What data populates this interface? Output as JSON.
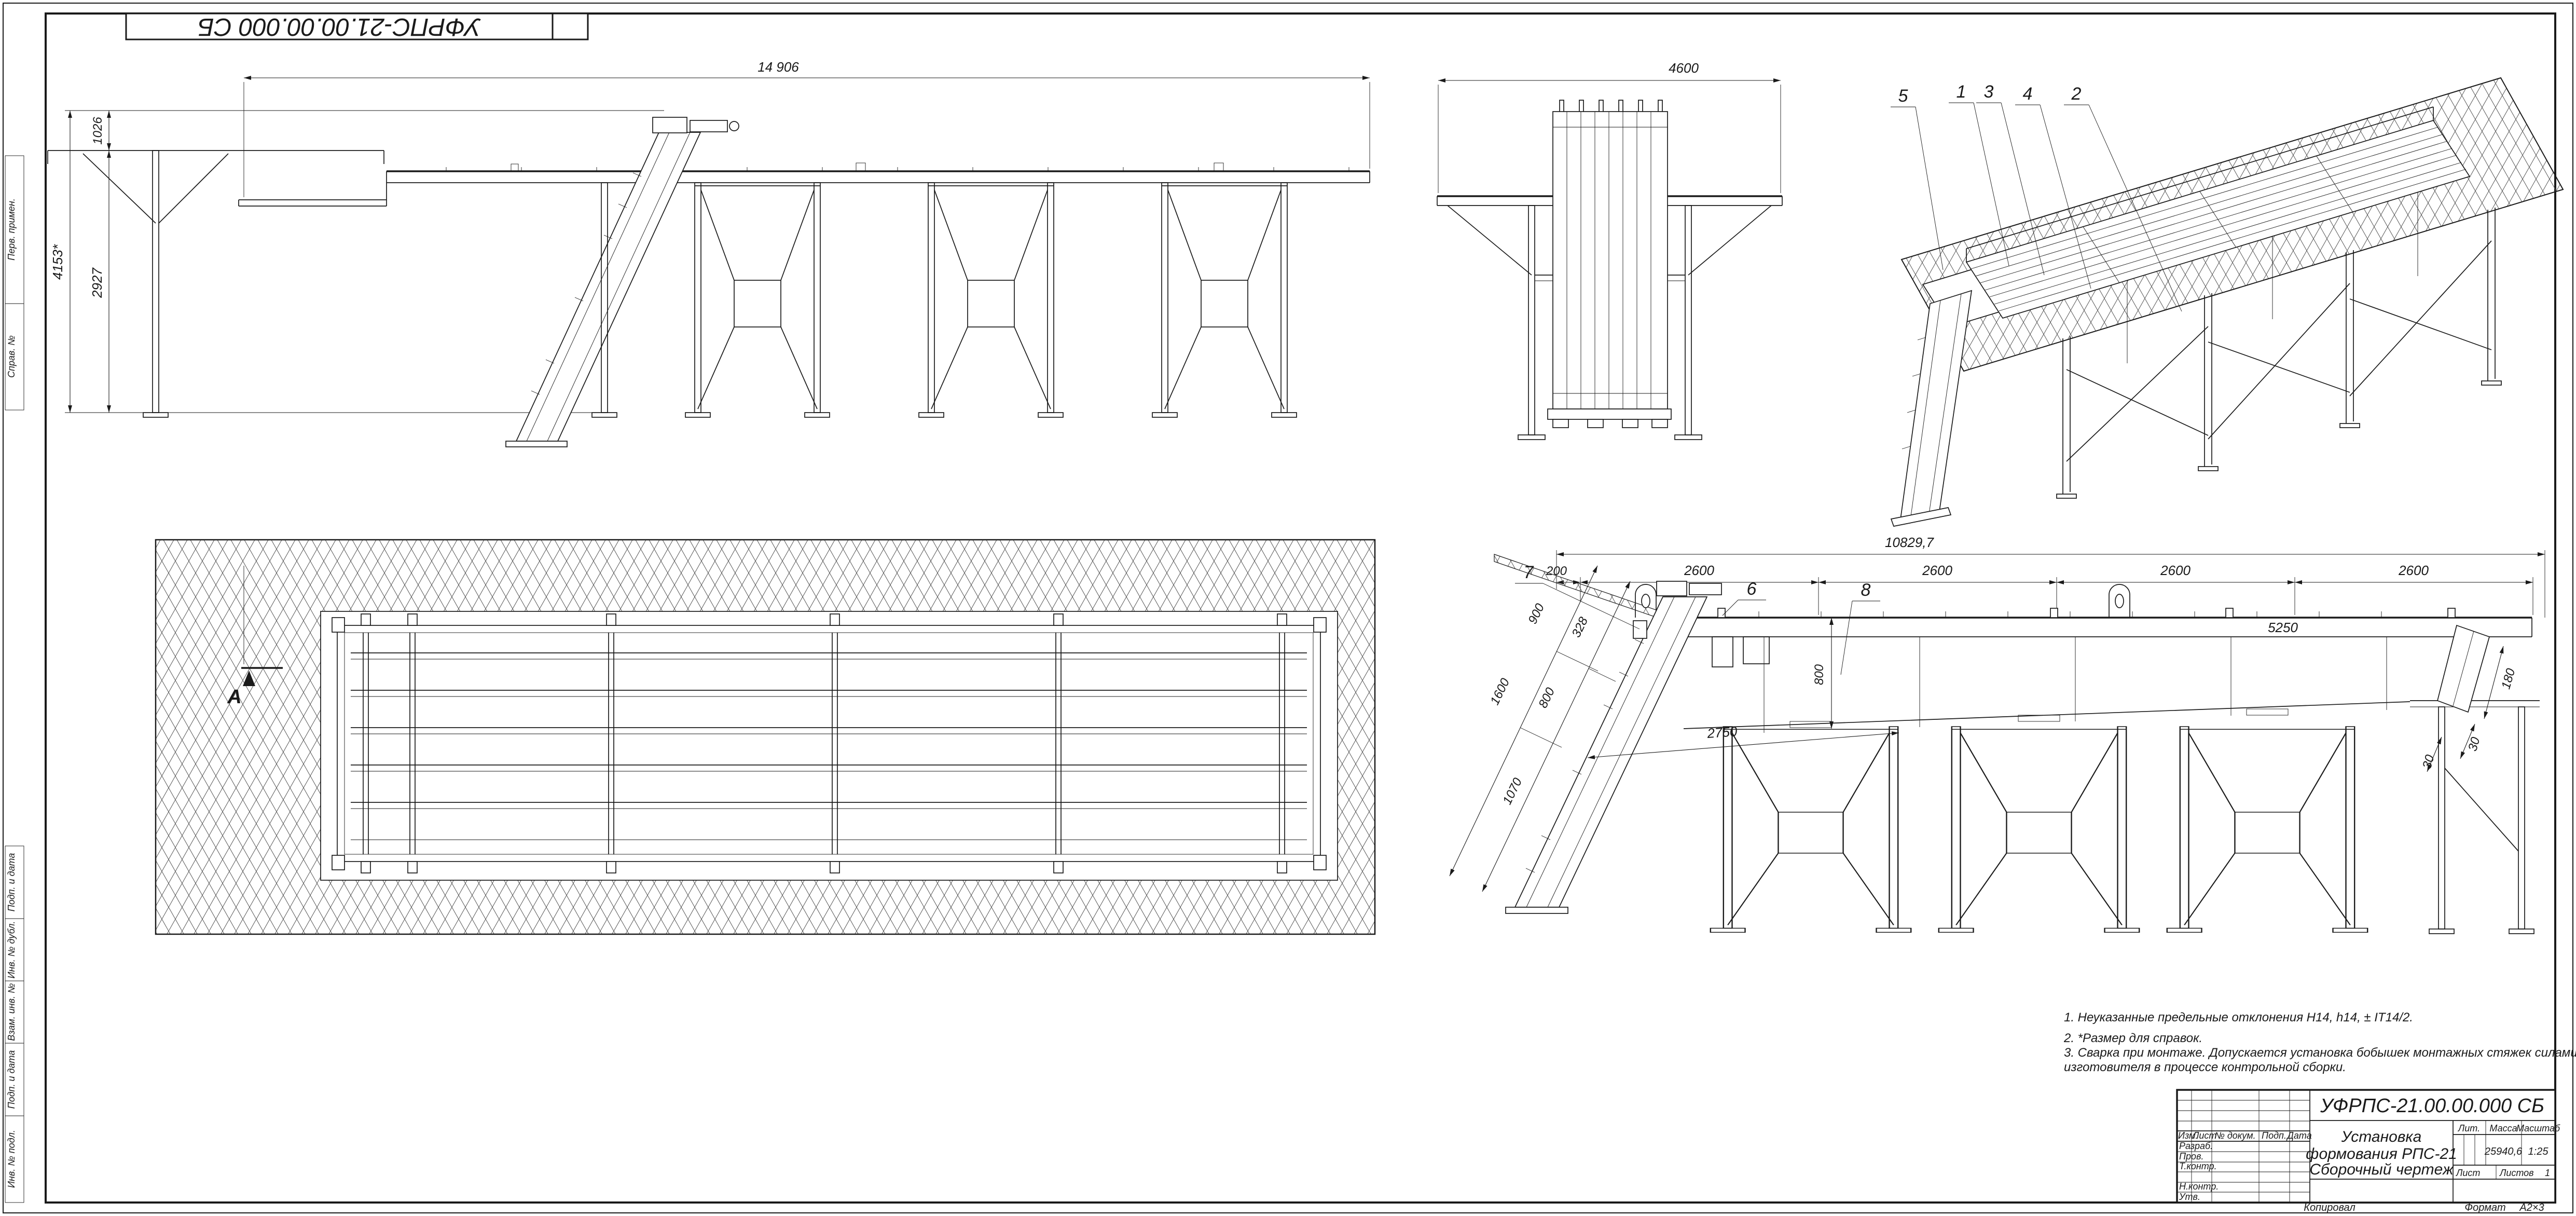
{
  "sheet": {
    "stamp": "УФРПС-21.00.00.000 СБ",
    "copied": "Копировал",
    "format_label": "Формат",
    "format_value": "А2×3"
  },
  "margin": {
    "top": [
      "Перв. примен.",
      "Справ. №"
    ],
    "bottom": [
      "Подп. и дата",
      "Инв. № дубл.",
      "Взам. инв. №",
      "Подп. и дата",
      "Инв. № подл."
    ]
  },
  "title_block": {
    "designation": "УФРПС-21.00.00.000 СБ",
    "name1": "Установка",
    "name2": "формования РПС-21",
    "name3": "Сборочный чертеж",
    "lit_label": "Лит.",
    "mass_label": "Масса",
    "scale_label": "Масштаб",
    "mass_value": "25940,6",
    "scale_value": "1:25",
    "sheet_label": "Лист",
    "sheets_label": "Листов",
    "sheets_value": "1",
    "col_izm": "Изм.",
    "col_list": "Лист",
    "col_doc": "№ докум.",
    "col_sign": "Подп.",
    "col_date": "Дата",
    "row_razrab": "Разраб.",
    "row_prov": "Пров.",
    "row_tkontr": "Т.контр.",
    "row_nkontr": "Н.контр.",
    "row_utv": "Утв."
  },
  "notes": {
    "lines": [
      "1. Неуказанные предельные отклонения Н14, h14, ± IT14/2.",
      "2. *Размер для справок.",
      "3. Сварка при монтаже. Допускается установка бобышек монтажных стяжек силами предприятия",
      "изготовителя в процессе контрольной сборки."
    ]
  },
  "views": {
    "side": {
      "dim_top": "14 906",
      "dim_h1": "1026",
      "dim_h2": "2927",
      "dim_overall": "4153*"
    },
    "end": {
      "dim_top": "4600"
    },
    "iso": {
      "callouts": [
        "5",
        "1",
        "3",
        "4",
        "2"
      ]
    },
    "plan": {
      "section": "А"
    },
    "detail": {
      "dim_top": "10829,7",
      "dim_200": "200",
      "dim_2600": "2600",
      "dim_5250": "5250",
      "dim_900": "900",
      "dim_328": "328",
      "dim_1600": "1600",
      "dim_800v": "800",
      "dim_800i": "800",
      "dim_1070": "1070",
      "dim_2750": "2750",
      "dim_180": "180",
      "dim_30": "30",
      "c6": "6",
      "c7": "7",
      "c8": "8"
    }
  }
}
